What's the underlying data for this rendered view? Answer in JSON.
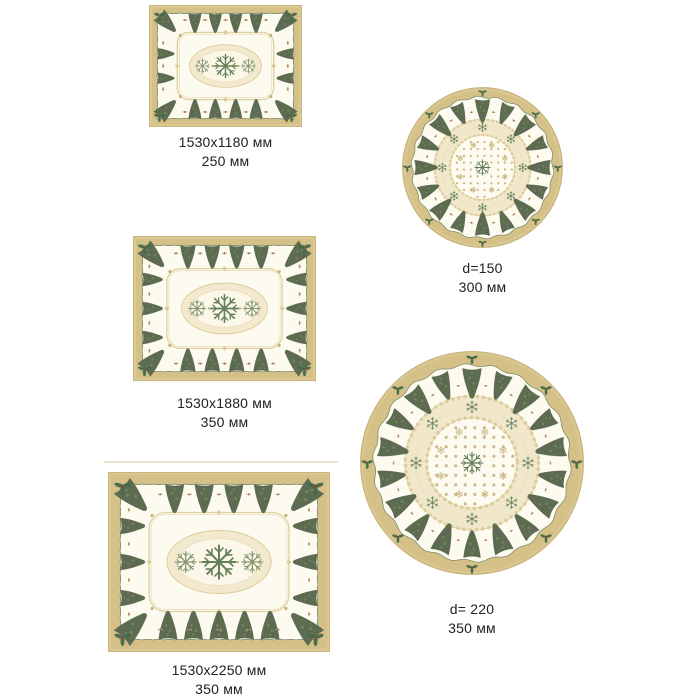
{
  "page": {
    "background_color": "#ffffff",
    "text_color": "#212121"
  },
  "palette": {
    "border_tan": "#d5c088",
    "border_edge": "#c3ab6e",
    "border_light": "#decd9b",
    "cloth_cream": "#fdfbf0",
    "edge_green": "#6b8160",
    "tree_green": "#5d6b51",
    "tree_light": "#7f8e6d",
    "lace_light": "#f2e9cf",
    "lace_mid": "#dccb98",
    "lace_dark": "#c6b27c",
    "star_green": "#64805a",
    "flank_green": "#87976f",
    "holly_green": "#3f6d49",
    "accent_red": "#a35c3a",
    "dot_beige": "#cbb888"
  },
  "products": [
    {
      "id": "tablecloth-1530x1180",
      "shape": "rectangle",
      "size_label": "1530x1180 мм",
      "height_label": "250 мм"
    },
    {
      "id": "tablecloth-d150",
      "shape": "round",
      "size_label": "d=150",
      "height_label": "300 мм"
    },
    {
      "id": "tablecloth-1530x1880",
      "shape": "rectangle",
      "size_label": "1530x1880 мм",
      "height_label": "350 мм"
    },
    {
      "id": "tablecloth-d220",
      "shape": "round",
      "size_label": "d= 220",
      "height_label": "350 мм"
    },
    {
      "id": "tablecloth-1530x2250",
      "shape": "rectangle",
      "size_label": "1530x2250 мм",
      "height_label": "350 мм"
    }
  ]
}
